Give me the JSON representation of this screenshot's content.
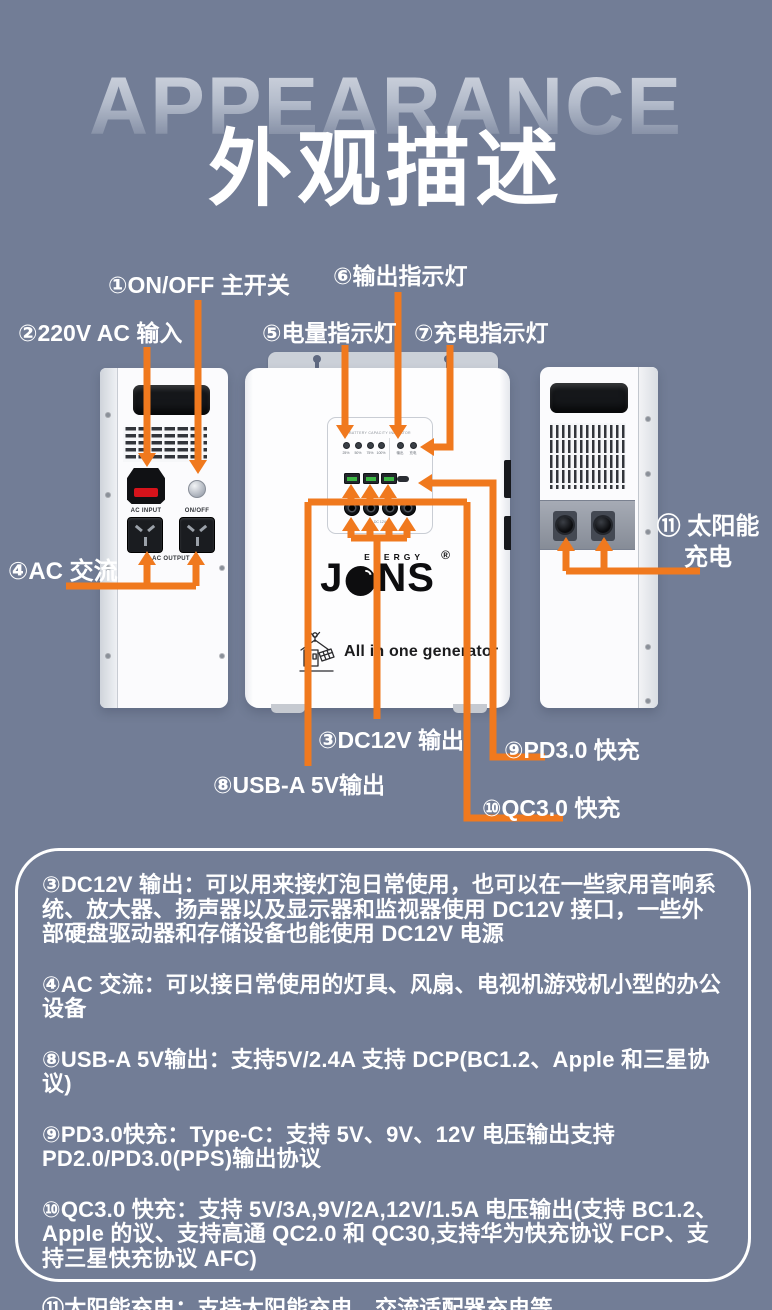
{
  "page": {
    "bg_color": "#727D96",
    "accent_color": "#F0791E"
  },
  "header": {
    "ghost_title": "APPEARANCE",
    "title": "外观描述"
  },
  "callouts": {
    "on_off": "①ON/OFF 主开关",
    "ac_input": "②220V AC 输入",
    "output_led": "⑥输出指示灯",
    "battery_led": "⑤电量指示灯",
    "charge_led": "⑦充电指示灯",
    "ac_out": "④AC 交流",
    "solar_line1": "⑪ 太阳能",
    "solar_line2": "充电",
    "dc12v": "③DC12V 输出",
    "pd30": "⑨PD3.0 快充",
    "usb": "⑧USB-A 5V输出",
    "qc30": "⑩QC3.0 快充"
  },
  "device": {
    "left": {
      "ac_input_label": "AC INPUT",
      "onoff_label": "ON/OFF",
      "ac_output_label": "AC OUTPUT"
    },
    "front": {
      "panel_header": "BATTERY CAPACITY INDICATOR",
      "led_labels": [
        "25%",
        "50%",
        "75%",
        "100%",
        "输出",
        "充电"
      ],
      "dc_label": "DC 12V",
      "brand_j": "J",
      "brand_ns": "NS",
      "brand_energy": "ENERGY",
      "brand_reg": "®",
      "tagline": "All in one generator"
    }
  },
  "description_card": {
    "paragraphs": [
      "③DC12V 输出：可以用来接灯泡日常使用，也可以在一些家用音响系统、放大器、扬声器以及显示器和监视器使用 DC12V 接口，一些外部硬盘驱动器和存储设备也能使用 DC12V 电源",
      "④AC 交流：可以接日常使用的灯具、风扇、电视机游戏机小型的办公设备",
      "⑧USB-A 5V输出：支持5V/2.4A 支持 DCP(BC1.2、Apple 和三星协议)",
      "⑨PD3.0快充：Type-C：支持 5V、9V、12V 电压输出支持 PD2.0/PD3.0(PPS)输出协议",
      "⑩QC3.0 快充：支持 5V/3A,9V/2A,12V/1.5A 电压输出(支持 BC1.2、Apple 的议、支持高通 QC2.0 和 QC30,支持华为快充协议 FCP、支持三星快充协议 AFC)",
      "⑪太阳能充电：支持太阳能充电，交流适配器充电等。"
    ]
  }
}
